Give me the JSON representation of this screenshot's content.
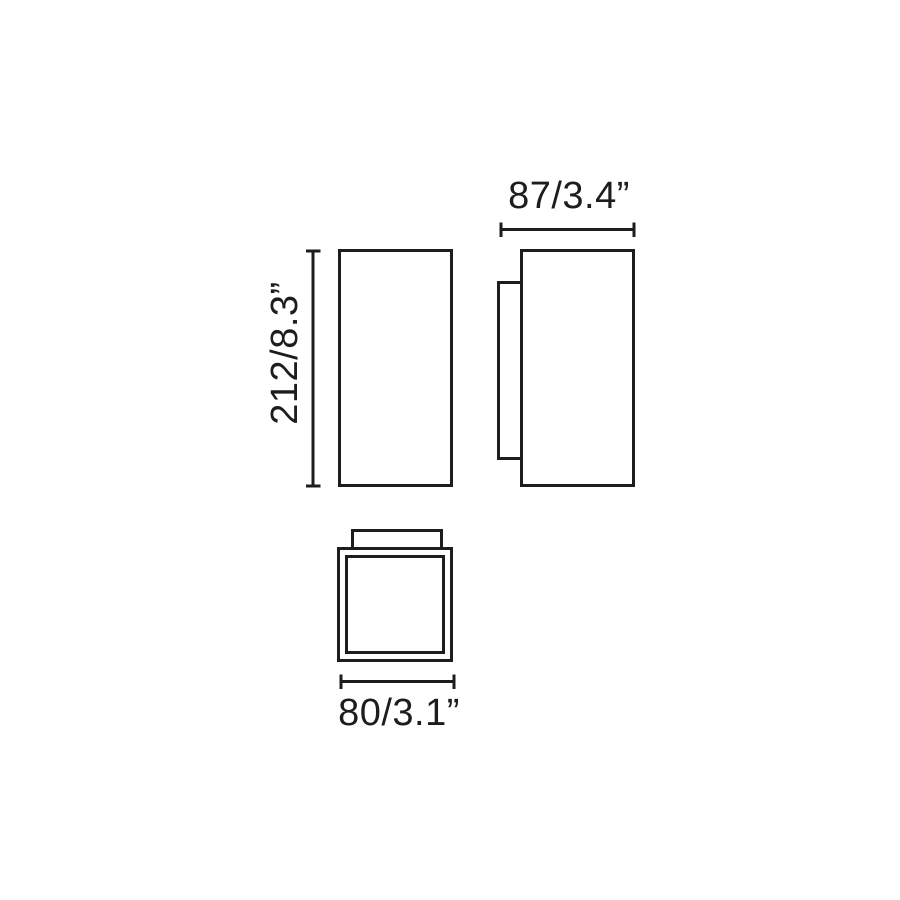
{
  "page": {
    "background": "#ffffff"
  },
  "colors": {
    "line": "#1d1d1b",
    "text": "#1d1d1b"
  },
  "drawing": {
    "kind": "technical dimension drawing with three orthographic views (front, side, bottom)",
    "dimensions": {
      "height": {
        "label": "212/8.3”",
        "mm": 212,
        "inches": 8.3
      },
      "depth": {
        "label": "87/3.4”",
        "mm": 87,
        "inches": 3.4
      },
      "width": {
        "label": "80/3.1”",
        "mm": 80,
        "inches": 3.1
      }
    }
  }
}
